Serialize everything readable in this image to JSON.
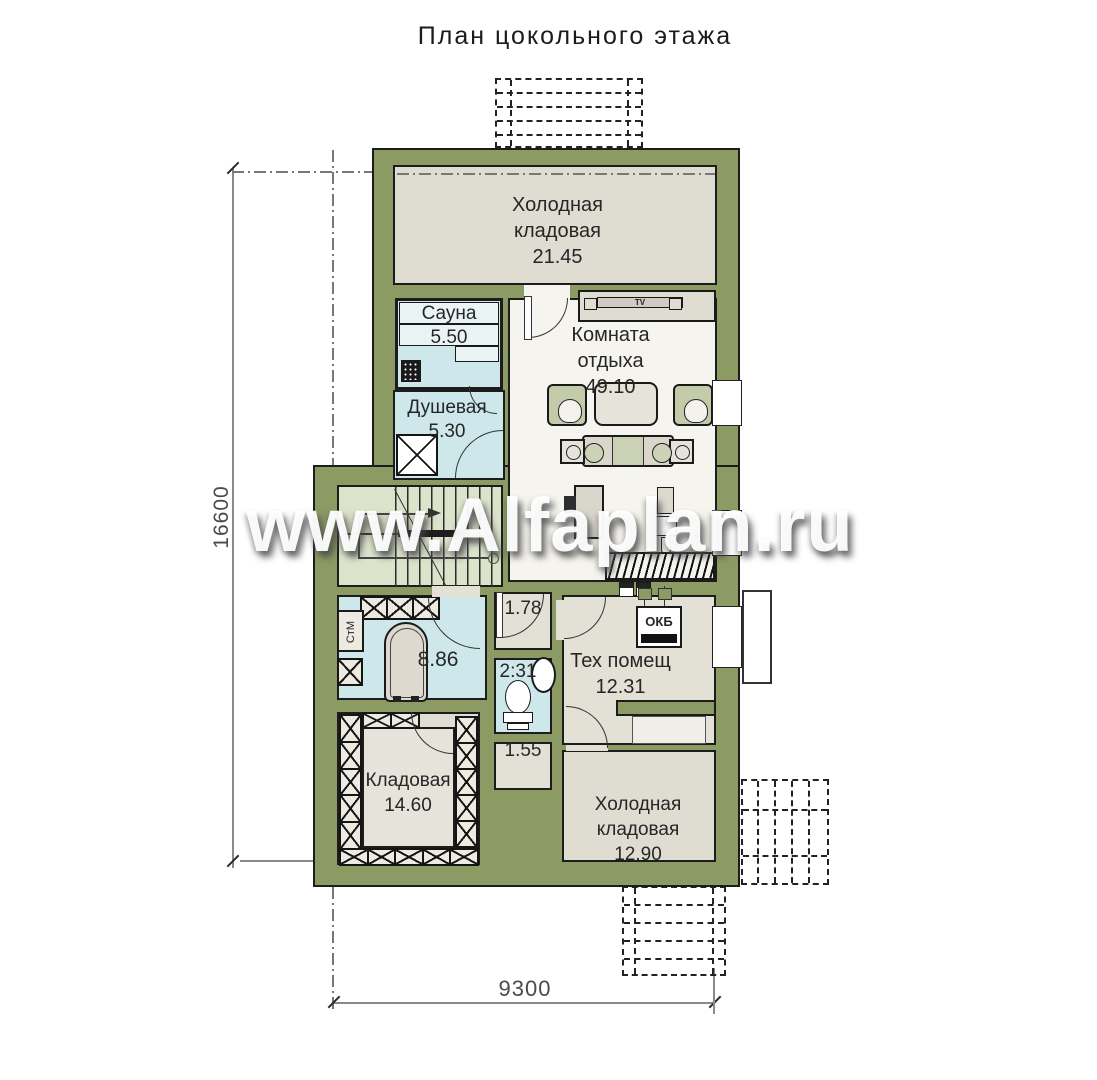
{
  "title": "План цокольного этажа",
  "watermark": "www.Alfaplan.ru",
  "dimensions": {
    "height_mm": "16600",
    "width_mm": "9300"
  },
  "rooms": {
    "cold_storage_top": {
      "label": "Холодная\nкладовая\n21.45"
    },
    "sauna": {
      "label": "Сауна\n5.50"
    },
    "shower": {
      "label": "Душевая\n5.30"
    },
    "lounge": {
      "label": "Комната\nотдыха\n49.10"
    },
    "hall": {
      "label": "1.78"
    },
    "wc": {
      "label": "2:31"
    },
    "laundry": {
      "label": "8.86"
    },
    "tech_room": {
      "label": "Тех помещ\n12.31"
    },
    "corridor": {
      "label": "1.55"
    },
    "storage": {
      "label": "Кладовая\n14.60"
    },
    "cold_storage_bottom": {
      "label": "Холодная\nкладовая\n12.90"
    }
  },
  "equipment": {
    "tv": "TV",
    "boiler": "ОКБ",
    "washer": "СтМ"
  },
  "colors": {
    "wall": "#8C9A63",
    "room_warm": "#E3E0D6",
    "room_gray": "#DFDCD2",
    "room_blue": "#CDE7EA",
    "room_green": "#DBE3CB",
    "floor_white": "#F6F4EE",
    "outline": "#1C1C1C"
  }
}
